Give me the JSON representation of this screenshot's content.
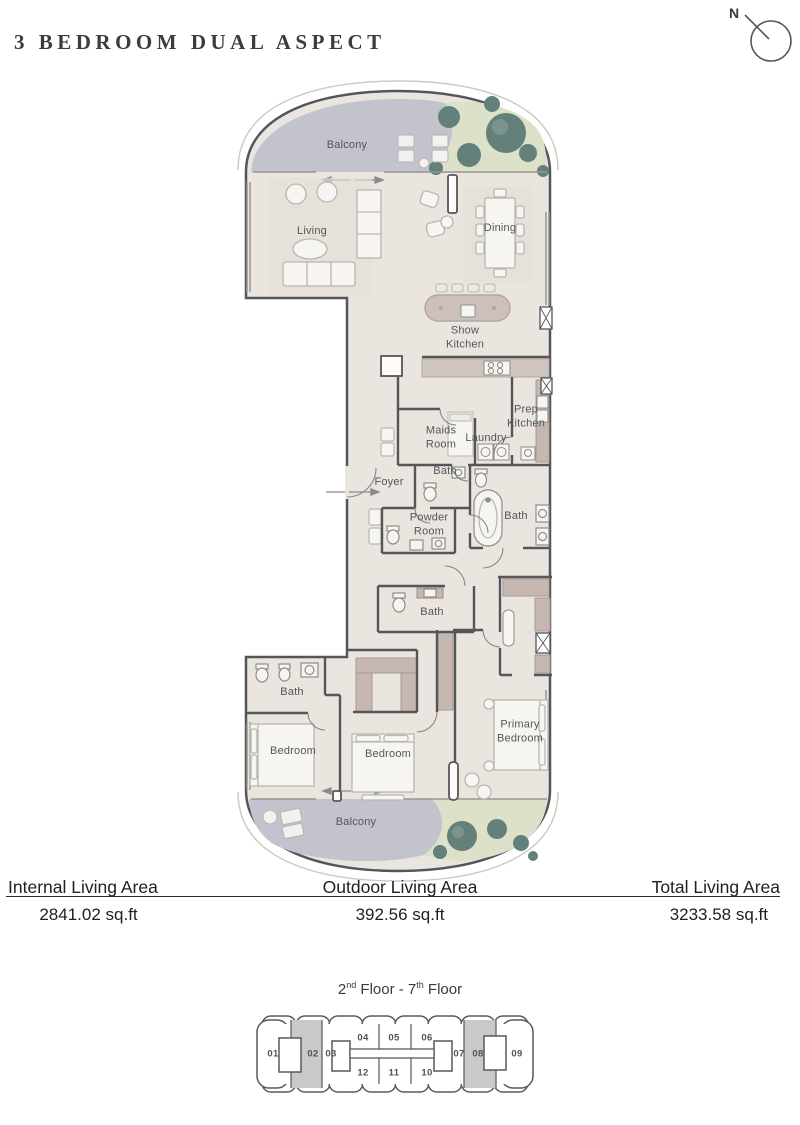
{
  "title": "3 BEDROOM DUAL ASPECT",
  "compass": {
    "north_label": "N"
  },
  "floorplan": {
    "rooms": {
      "balcony": "Balcony",
      "living": "Living",
      "dining": "Dining",
      "show_kitchen": "Show Kitchen",
      "maids_room": "Maids Room",
      "laundry": "Laundry",
      "prep_kitchen": "Prep Kitchen",
      "foyer": "Foyer",
      "bath": "Bath",
      "powder_room": "Powder Room",
      "bedroom": "Bedroom",
      "primary_bedroom": "Primary Bedroom"
    },
    "colors": {
      "floor": "#eae6df",
      "balcony": "#c2c3cd",
      "greenery": "#dde1ca",
      "tree": "#64807a",
      "wall": "#55565a",
      "wardrobe": "#c6b8b1",
      "kitchen_island": "#ccbfbc"
    }
  },
  "areas": {
    "internal": {
      "label": "Internal Living Area",
      "value": "2841.02 sq.ft"
    },
    "outdoor": {
      "label": "Outdoor Living Area",
      "value": "392.56 sq.ft"
    },
    "total": {
      "label": "Total Living Area",
      "value": "3233.58 sq.ft"
    }
  },
  "keyplan": {
    "floor_label": {
      "base1": "2",
      "sup1": "nd",
      "base2": " Floor - 7",
      "sup2": "th",
      "base3": " Floor"
    },
    "units": [
      "01",
      "02",
      "03",
      "04",
      "05",
      "06",
      "07",
      "08",
      "09",
      "10",
      "11",
      "12"
    ],
    "highlighted_units": [
      "02",
      "08"
    ],
    "highlight_color": "#c9c9c9"
  }
}
